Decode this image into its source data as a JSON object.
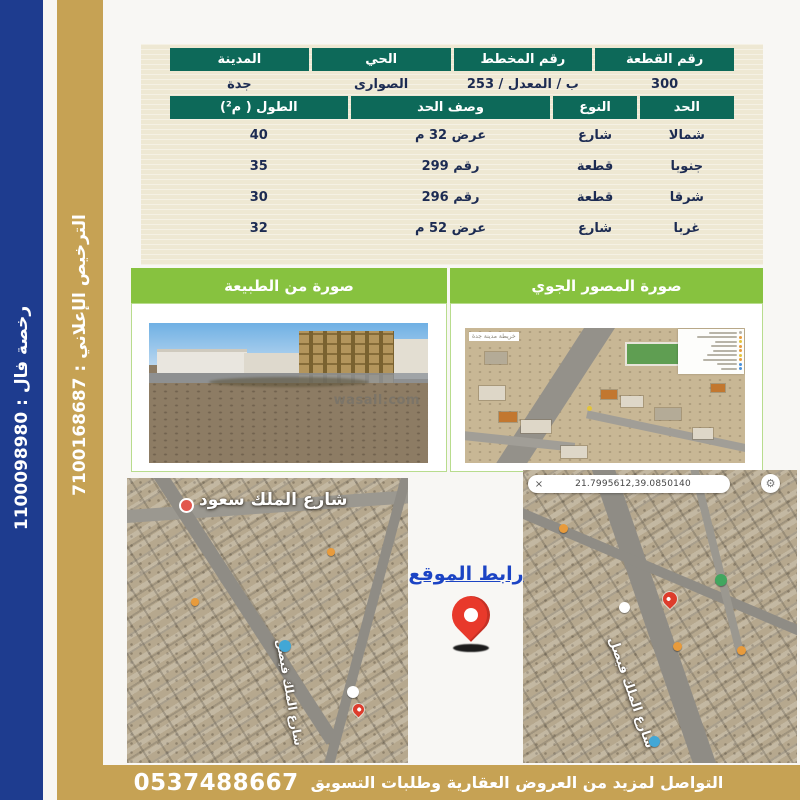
{
  "sidebar": {
    "fal_license": "رخصة فال : 1100098980",
    "ad_license": "الترخيص الإعلاني : 7100168687"
  },
  "info_table": {
    "headers": [
      "رقم القطعة",
      "رقم المخطط",
      "الحي",
      "المدينة"
    ],
    "values": [
      "300",
      "ب / المعدل / 253",
      "الصوارى",
      "جدة"
    ]
  },
  "bounds_table": {
    "headers": [
      "الحد",
      "النوع",
      "وصف الحد",
      "الطول ( م²)"
    ],
    "rows": [
      {
        "side": "شمالا",
        "type": "شارع",
        "desc": "عرض 32 م",
        "length": "40"
      },
      {
        "side": "جنوبا",
        "type": "قطعة",
        "desc": "رقم 299",
        "length": "35"
      },
      {
        "side": "شرقا",
        "type": "قطعة",
        "desc": "رقم 296",
        "length": "30"
      },
      {
        "side": "غربا",
        "type": "شارع",
        "desc": "عرض 52 م",
        "length": "32"
      }
    ]
  },
  "photos": {
    "aerial_title": "صورة المصور الجوي",
    "nature_title": "صورة من الطبيعة",
    "watermark": "wasall.com",
    "aerial_map_label": "خريطة مدينة جدة"
  },
  "maps": {
    "site_link_label": "رابط الموقع",
    "street_king_saud": "شارع الملك سعود",
    "street_king_faisal": "شارع الملك فيصل",
    "coordinates": "21.7995612,39.0850140",
    "close_glyph": "×",
    "gear_glyph": "⚙"
  },
  "footer": {
    "message": "التواصل لمزيد من العروض العقارية وطلبات التسويق",
    "phone": "0537488667"
  },
  "colors": {
    "navy_bar": "#1e3c8f",
    "gold": "#c6a254",
    "teal_header": "#0d6959",
    "green_header": "#87c23f",
    "cream_panel": "#eee8d3",
    "link_blue": "#1c44c4",
    "pin_red": "#e8392b"
  }
}
